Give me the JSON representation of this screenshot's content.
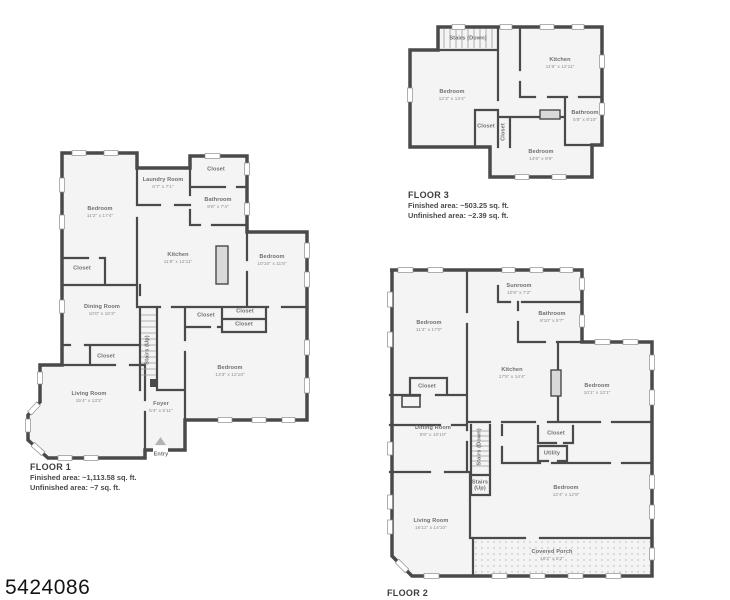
{
  "photo_id": "5424086",
  "colors": {
    "wall": "#4a4a4a",
    "room_fill": "#f4f4f4",
    "background": "#ffffff"
  },
  "floors": [
    {
      "title": "FLOOR 1",
      "finished": "Finished area: ~1,113.58 sq. ft.",
      "unfinished": "Unfinished area: ~7 sq. ft.",
      "rooms": [
        {
          "name": "Bedroom",
          "dims": "11'2\" x 17'4\""
        },
        {
          "name": "Closet",
          "dims": ""
        },
        {
          "name": "Laundry Room",
          "dims": "6'7\" x 7'1\""
        },
        {
          "name": "Closet",
          "dims": ""
        },
        {
          "name": "Bathroom",
          "dims": "8'8\" x 7'4\""
        },
        {
          "name": "Kitchen",
          "dims": "11'8\" x 12'11\""
        },
        {
          "name": "Bedroom",
          "dims": "10'10\" x 11'8\""
        },
        {
          "name": "Dining Room",
          "dims": "10'0\" x 10'3\""
        },
        {
          "name": "Closet",
          "dims": ""
        },
        {
          "name": "Stairs (Up)",
          "dims": ""
        },
        {
          "name": "Closet",
          "dims": ""
        },
        {
          "name": "Closet",
          "dims": ""
        },
        {
          "name": "Closet",
          "dims": ""
        },
        {
          "name": "Bedroom",
          "dims": "13'3\" x 12'10\""
        },
        {
          "name": "Living Room",
          "dims": "15'4\" x 13'2\""
        },
        {
          "name": "Foyer",
          "dims": "5'4\" x 5'11\""
        },
        {
          "name": "Entry",
          "dims": ""
        }
      ]
    },
    {
      "title": "FLOOR 2",
      "rooms": [
        {
          "name": "Bedroom",
          "dims": "11'4\" x 17'0\""
        },
        {
          "name": "Sunroom",
          "dims": "10'9\" x 7'2\""
        },
        {
          "name": "Bathroom",
          "dims": "8'10\" x 5'7\""
        },
        {
          "name": "Closet",
          "dims": ""
        },
        {
          "name": "Kitchen",
          "dims": "17'5\" x 14'4\""
        },
        {
          "name": "Bedroom",
          "dims": "10'1\" x 13'1\""
        },
        {
          "name": "Dining Room",
          "dims": "9'8\" x 10'10\""
        },
        {
          "name": "Stairs (Down)",
          "dims": ""
        },
        {
          "name": "Stairs (Up)",
          "dims": ""
        },
        {
          "name": "Closet",
          "dims": ""
        },
        {
          "name": "Utility",
          "dims": ""
        },
        {
          "name": "Bedroom",
          "dims": "12'4\" x 12'9\""
        },
        {
          "name": "Living Room",
          "dims": "16'11\" x 14'10\""
        },
        {
          "name": "Covered Porch",
          "dims": "19'2\" x 6'2\""
        }
      ]
    },
    {
      "title": "FLOOR 3",
      "finished": "Finished area: ~503.25 sq. ft.",
      "unfinished": "Unfinished area: ~2.39 sq. ft.",
      "rooms": [
        {
          "name": "Stairs (Down)",
          "dims": ""
        },
        {
          "name": "Bedroom",
          "dims": "12'3\" x 13'4\""
        },
        {
          "name": "Kitchen",
          "dims": "11'6\" x 12'11\""
        },
        {
          "name": "Closet",
          "dims": ""
        },
        {
          "name": "Closet",
          "dims": ""
        },
        {
          "name": "Bathroom",
          "dims": "5'8\" x 8'10\""
        },
        {
          "name": "Bedroom",
          "dims": "14'6\" x 9'6\""
        }
      ]
    }
  ]
}
